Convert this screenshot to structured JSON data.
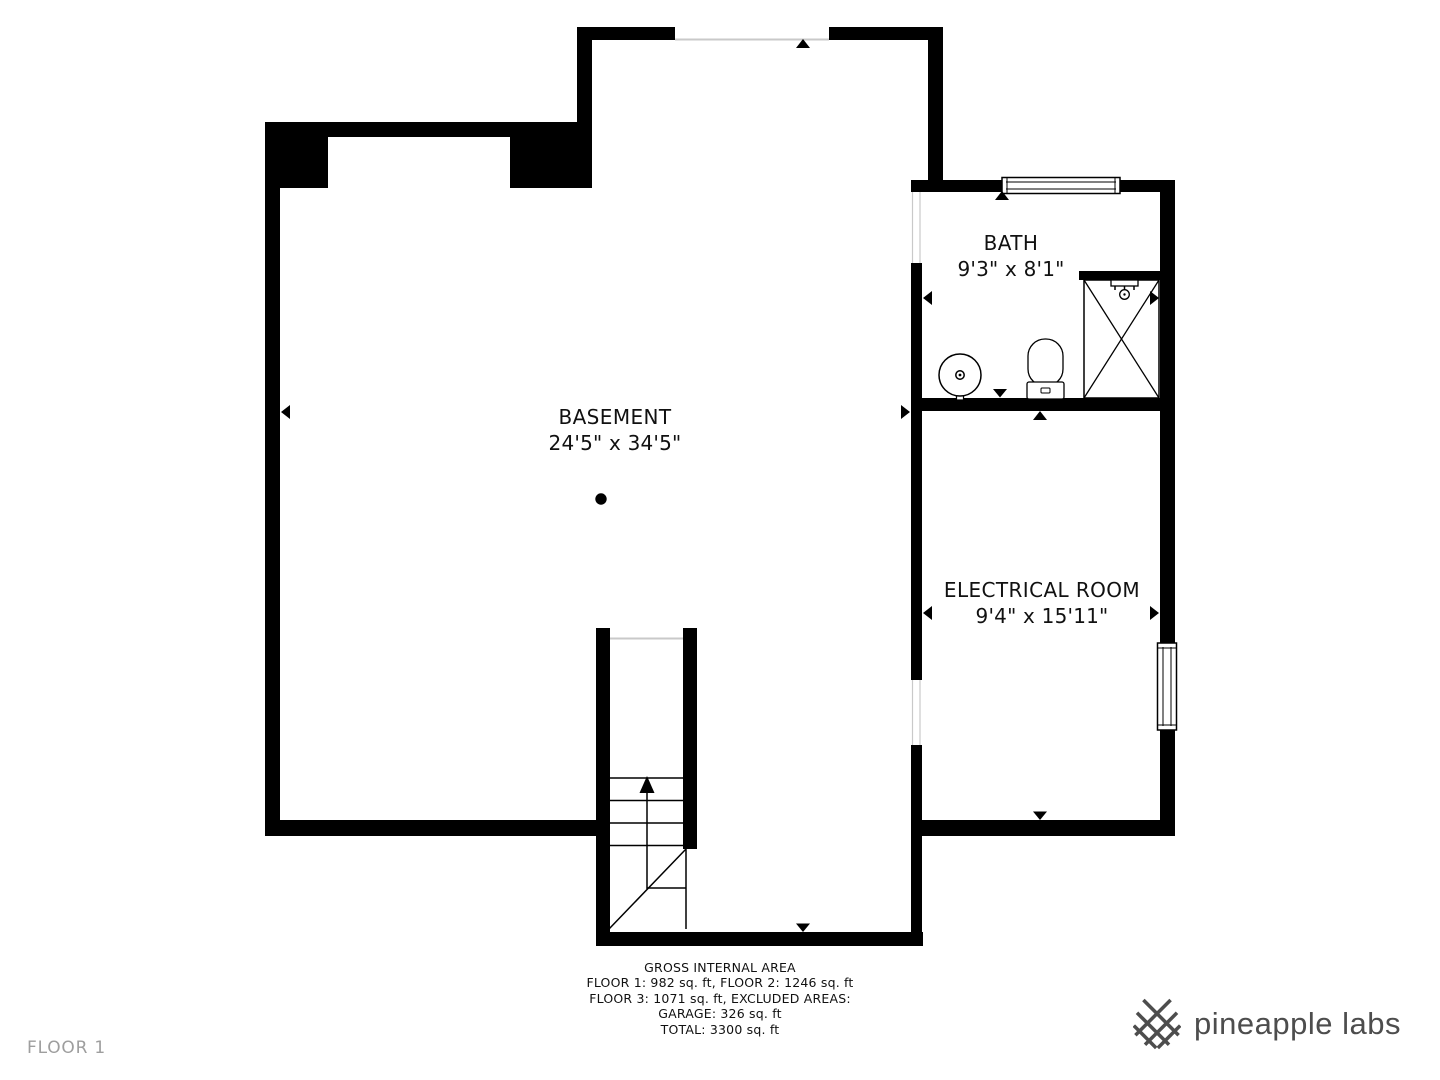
{
  "floor_label": "FLOOR 1",
  "rooms": [
    {
      "name": "BASEMENT",
      "dimensions": "24'5\" x 34'5\""
    },
    {
      "name": "BATH",
      "dimensions": "9'3\" x 8'1\""
    },
    {
      "name": "ELECTRICAL ROOM",
      "dimensions": "9'4\" x 15'11\""
    }
  ],
  "area_summary": {
    "title": "GROSS INTERNAL AREA",
    "line1": "FLOOR 1: 982 sq. ft, FLOOR 2: 1246 sq. ft",
    "line2": "FLOOR 3: 1071 sq. ft, EXCLUDED AREAS:",
    "line3": "GARAGE: 326 sq. ft",
    "line4": "TOTAL: 3300 sq. ft"
  },
  "branding": {
    "logo_text": "pineapple labs",
    "logo_icon": "pineapple-lattice-icon"
  },
  "colors": {
    "wall": "#000000",
    "background": "#ffffff",
    "opening_line": "#c9c9c9",
    "floor_label_gray": "#9e9e9e",
    "logo_gray": "#4d4d4d"
  }
}
